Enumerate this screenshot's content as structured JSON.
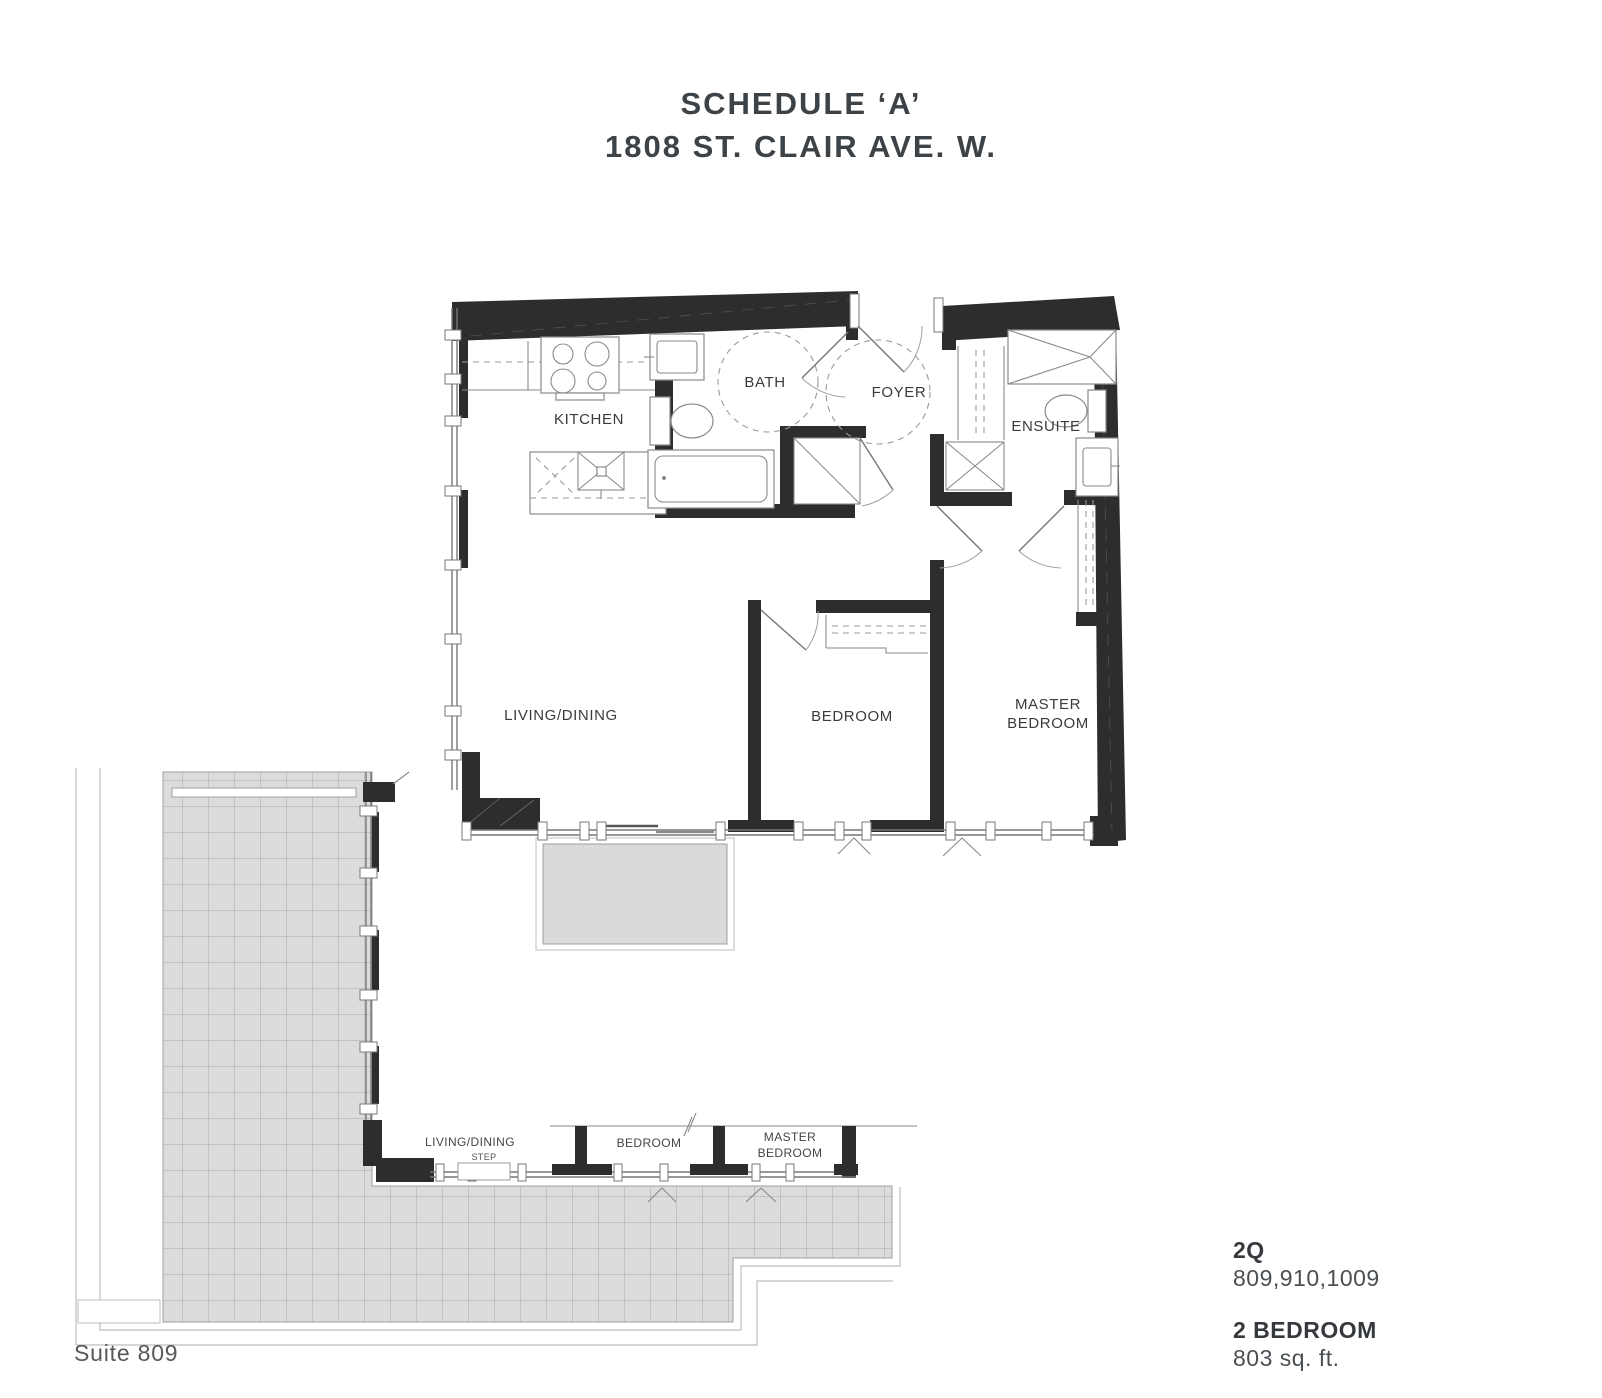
{
  "title": {
    "line1": "SCHEDULE ‘A’",
    "line2": "1808 ST. CLAIR AVE. W."
  },
  "main_plan": {
    "kitchen": "KITCHEN",
    "bath": "BATH",
    "foyer": "FOYER",
    "ensuite": "ENSUITE",
    "living_dining": "LIVING/DINING",
    "bedroom": "BEDROOM",
    "master_bedroom_line1": "MASTER",
    "master_bedroom_line2": "BEDROOM"
  },
  "mini_plan": {
    "living_dining": "LIVING/DINING",
    "step": "STEP",
    "bedroom": "BEDROOM",
    "master_bedroom_line1": "MASTER",
    "master_bedroom_line2": "BEDROOM"
  },
  "info": {
    "model": "2Q",
    "suite_numbers": "809,910,1009",
    "unit_type": "2 BEDROOM",
    "area": "803 sq. ft."
  },
  "caption": "Suite 809",
  "colors": {
    "wall": "#2d2d2d",
    "line": "#777777",
    "terrace_fill": "#dcdcdc",
    "terrace_grid": "#a9a9a9",
    "balcony_fill": "#dadada",
    "title_text": "#3d4247",
    "label_text": "#3b3b3b",
    "caption_text": "#58595b"
  }
}
